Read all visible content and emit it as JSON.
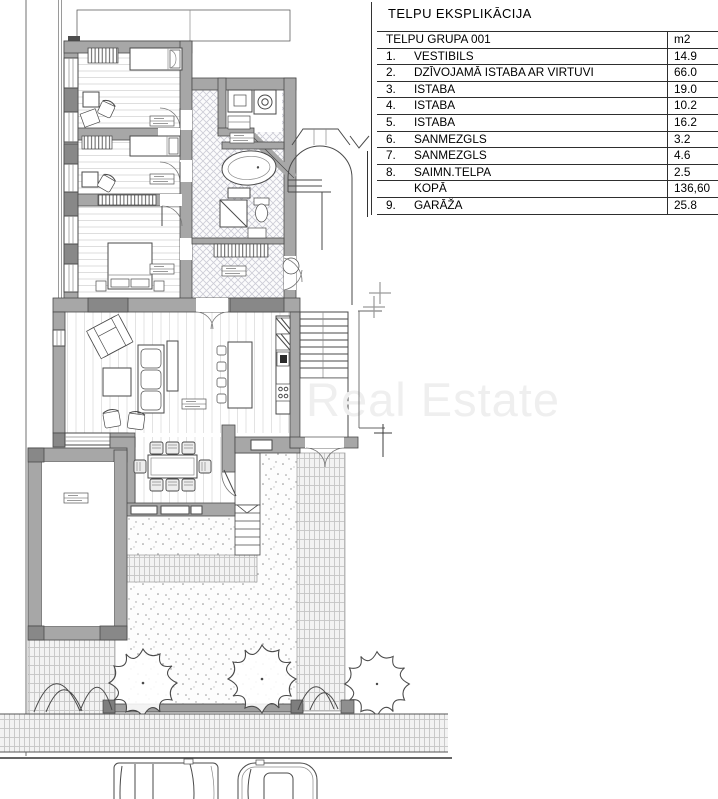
{
  "title_block": {
    "title": "TELPU EKSPLIKĀCIJA",
    "group_header": "TELPU GRUPA 001",
    "unit_header": "m2",
    "rows": [
      {
        "num": "1.",
        "label": "VESTIBILS",
        "area": "14.9"
      },
      {
        "num": "2.",
        "label": "DZĪVOJAMĀ ISTABA AR VIRTUVI",
        "area": "66.0"
      },
      {
        "num": "3.",
        "label": "ISTABA",
        "area": "19.0"
      },
      {
        "num": "4.",
        "label": "ISTABA",
        "area": "10.2"
      },
      {
        "num": "5.",
        "label": "ISTABA",
        "area": "16.2"
      },
      {
        "num": "6.",
        "label": "SANMEZGLS",
        "area": "3.2"
      },
      {
        "num": "7.",
        "label": "SANMEZGLS",
        "area": "4.6"
      },
      {
        "num": "8.",
        "label": "SAIMN.TELPA",
        "area": "2.5"
      },
      {
        "num": "",
        "label": "KOPĀ",
        "area": "136,60"
      },
      {
        "num": "9.",
        "label": "GARĀŽA",
        "area": "25.8"
      }
    ]
  },
  "watermark": "Real Estate",
  "colors": {
    "wall_gray": "#a7a7a7",
    "wall_dark": "#888888",
    "line": "#4a4a4a",
    "watermark_gray": "#efefef",
    "table_border": "#2e2e2e"
  }
}
